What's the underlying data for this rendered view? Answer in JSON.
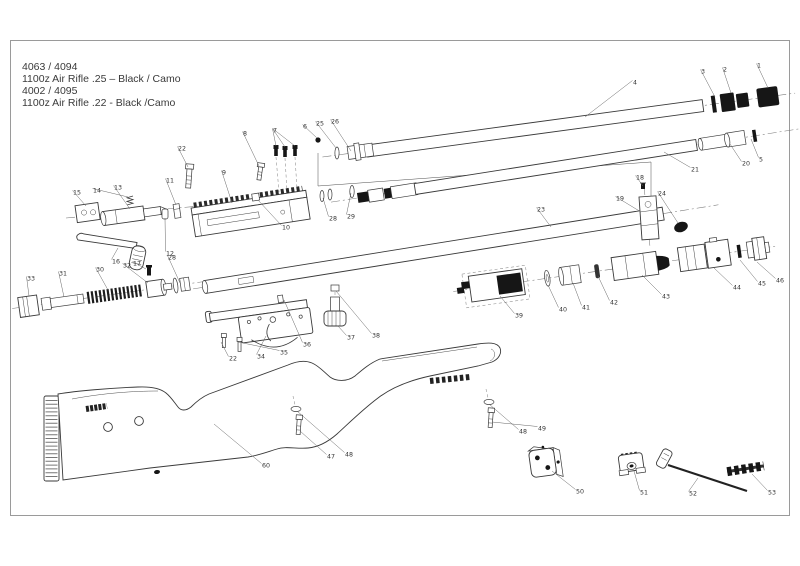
{
  "title": {
    "line1": "4063 / 4094",
    "line2": "1100z Air Rifle .25 – Black / Camo",
    "line3": "4002 / 4095",
    "line4": "1100z Air Rifle .22 - Black /Camo"
  },
  "diagram": {
    "kind": "exploded-parts-diagram",
    "colors": {
      "background": "#ffffff",
      "line": "#3a3a3a",
      "dark_fill": "#161616",
      "border": "#9a9a9a",
      "label": "#333333"
    },
    "part_labels": [
      {
        "n": "1",
        "x": 757,
        "y": 66,
        "t": [
          [
            768,
            88
          ]
        ]
      },
      {
        "n": "2",
        "x": 723,
        "y": 70,
        "t": [
          [
            731,
            93
          ]
        ]
      },
      {
        "n": "3",
        "x": 701,
        "y": 72,
        "t": [
          [
            715,
            97
          ]
        ]
      },
      {
        "n": "4",
        "x": 633,
        "y": 83,
        "t": [
          [
            585,
            117
          ]
        ]
      },
      {
        "n": "5",
        "x": 759,
        "y": 160,
        "t": [
          [
            751,
            139
          ]
        ]
      },
      {
        "n": "20",
        "x": 742,
        "y": 164,
        "t": [
          [
            730,
            144
          ]
        ]
      },
      {
        "n": "21",
        "x": 691,
        "y": 170,
        "t": [
          [
            664,
            152
          ]
        ]
      },
      {
        "n": "6",
        "x": 303,
        "y": 127,
        "t": [
          [
            317,
            138
          ]
        ]
      },
      {
        "n": "25",
        "x": 316,
        "y": 124,
        "t": [
          [
            336,
            148
          ]
        ]
      },
      {
        "n": "26",
        "x": 331,
        "y": 122,
        "t": [
          [
            351,
            151
          ]
        ]
      },
      {
        "n": "7",
        "x": 273,
        "y": 131,
        "t": [
          [
            276,
            146
          ],
          [
            285,
            147
          ],
          [
            295,
            146
          ]
        ]
      },
      {
        "n": "8",
        "x": 243,
        "y": 134,
        "t": [
          [
            259,
            166
          ]
        ]
      },
      {
        "n": "22",
        "x": 178,
        "y": 149,
        "t": [
          [
            188,
            167
          ]
        ]
      },
      {
        "n": "9",
        "x": 222,
        "y": 173,
        "t": [
          [
            232,
            203
          ]
        ]
      },
      {
        "n": "11",
        "x": 166,
        "y": 181,
        "t": [
          [
            176,
            205
          ]
        ]
      },
      {
        "n": "15",
        "x": 73,
        "y": 193,
        "t": [
          [
            86,
            206
          ]
        ]
      },
      {
        "n": "14",
        "x": 93,
        "y": 191,
        "t": [
          [
            128,
            197
          ]
        ]
      },
      {
        "n": "13",
        "x": 114,
        "y": 188,
        "t": [
          [
            130,
            209
          ]
        ]
      },
      {
        "n": "12",
        "x": 166,
        "y": 254,
        "t": [
          [
            165,
            218
          ]
        ]
      },
      {
        "n": "16",
        "x": 112,
        "y": 262,
        "t": [
          [
            118,
            248
          ]
        ]
      },
      {
        "n": "17",
        "x": 133,
        "y": 264,
        "t": [
          [
            146,
            269
          ]
        ]
      },
      {
        "n": "28",
        "x": 168,
        "y": 258,
        "t": [
          [
            180,
            283
          ]
        ]
      },
      {
        "n": "10",
        "x": 282,
        "y": 228,
        "t": [
          [
            258,
            200
          ]
        ]
      },
      {
        "n": "28",
        "x": 329,
        "y": 219,
        "t": [
          [
            323,
            198
          ]
        ]
      },
      {
        "n": "29",
        "x": 347,
        "y": 217,
        "t": [
          [
            351,
            193
          ]
        ]
      },
      {
        "n": "23",
        "x": 537,
        "y": 210,
        "t": [
          [
            551,
            227
          ]
        ]
      },
      {
        "n": "18",
        "x": 636,
        "y": 178,
        "t": [
          [
            643,
            186
          ]
        ]
      },
      {
        "n": "19",
        "x": 616,
        "y": 199,
        "t": [
          [
            641,
            212
          ]
        ]
      },
      {
        "n": "24",
        "x": 658,
        "y": 194,
        "t": [
          [
            678,
            223
          ]
        ]
      },
      {
        "n": "33",
        "x": 27,
        "y": 279,
        "t": [
          [
            29,
            296
          ]
        ]
      },
      {
        "n": "31",
        "x": 59,
        "y": 274,
        "t": [
          [
            64,
            297
          ]
        ]
      },
      {
        "n": "30",
        "x": 96,
        "y": 270,
        "t": [
          [
            108,
            290
          ]
        ]
      },
      {
        "n": "32",
        "x": 123,
        "y": 266,
        "t": [
          [
            148,
            283
          ]
        ]
      },
      {
        "n": "22",
        "x": 229,
        "y": 359,
        "t": [
          [
            221,
            342
          ]
        ]
      },
      {
        "n": "34",
        "x": 257,
        "y": 357,
        "t": [
          [
            266,
            336
          ]
        ]
      },
      {
        "n": "35",
        "x": 280,
        "y": 353,
        "t": [
          [
            238,
            342
          ]
        ]
      },
      {
        "n": "36",
        "x": 303,
        "y": 345,
        "t": [
          [
            284,
            300
          ]
        ]
      },
      {
        "n": "37",
        "x": 347,
        "y": 338,
        "t": [
          [
            338,
            326
          ]
        ]
      },
      {
        "n": "38",
        "x": 372,
        "y": 336,
        "t": [
          [
            336,
            291
          ]
        ]
      },
      {
        "n": "39",
        "x": 515,
        "y": 316,
        "t": [
          [
            500,
            296
          ]
        ]
      },
      {
        "n": "40",
        "x": 559,
        "y": 310,
        "t": [
          [
            548,
            285
          ]
        ]
      },
      {
        "n": "41",
        "x": 582,
        "y": 308,
        "t": [
          [
            573,
            283
          ]
        ]
      },
      {
        "n": "42",
        "x": 610,
        "y": 303,
        "t": [
          [
            598,
            276
          ]
        ]
      },
      {
        "n": "43",
        "x": 662,
        "y": 297,
        "t": [
          [
            642,
            275
          ]
        ]
      },
      {
        "n": "44",
        "x": 733,
        "y": 288,
        "t": [
          [
            714,
            268
          ]
        ]
      },
      {
        "n": "45",
        "x": 758,
        "y": 284,
        "t": [
          [
            740,
            260
          ]
        ]
      },
      {
        "n": "46",
        "x": 776,
        "y": 281,
        "t": [
          [
            757,
            262
          ]
        ]
      },
      {
        "n": "60",
        "x": 262,
        "y": 466,
        "t": [
          [
            214,
            424
          ]
        ]
      },
      {
        "n": "47",
        "x": 327,
        "y": 457,
        "t": [
          [
            300,
            431
          ]
        ]
      },
      {
        "n": "48",
        "x": 345,
        "y": 455,
        "t": [
          [
            297,
            411
          ]
        ]
      },
      {
        "n": "48",
        "x": 519,
        "y": 432,
        "t": [
          [
            489,
            404
          ]
        ]
      },
      {
        "n": "49",
        "x": 538,
        "y": 429,
        "t": [
          [
            492,
            422
          ]
        ]
      },
      {
        "n": "50",
        "x": 576,
        "y": 492,
        "t": [
          [
            552,
            471
          ]
        ]
      },
      {
        "n": "51",
        "x": 640,
        "y": 493,
        "t": [
          [
            634,
            471
          ]
        ]
      },
      {
        "n": "52",
        "x": 689,
        "y": 494,
        "t": [
          [
            698,
            478
          ]
        ]
      },
      {
        "n": "53",
        "x": 768,
        "y": 493,
        "t": [
          [
            752,
            474
          ]
        ]
      }
    ]
  }
}
